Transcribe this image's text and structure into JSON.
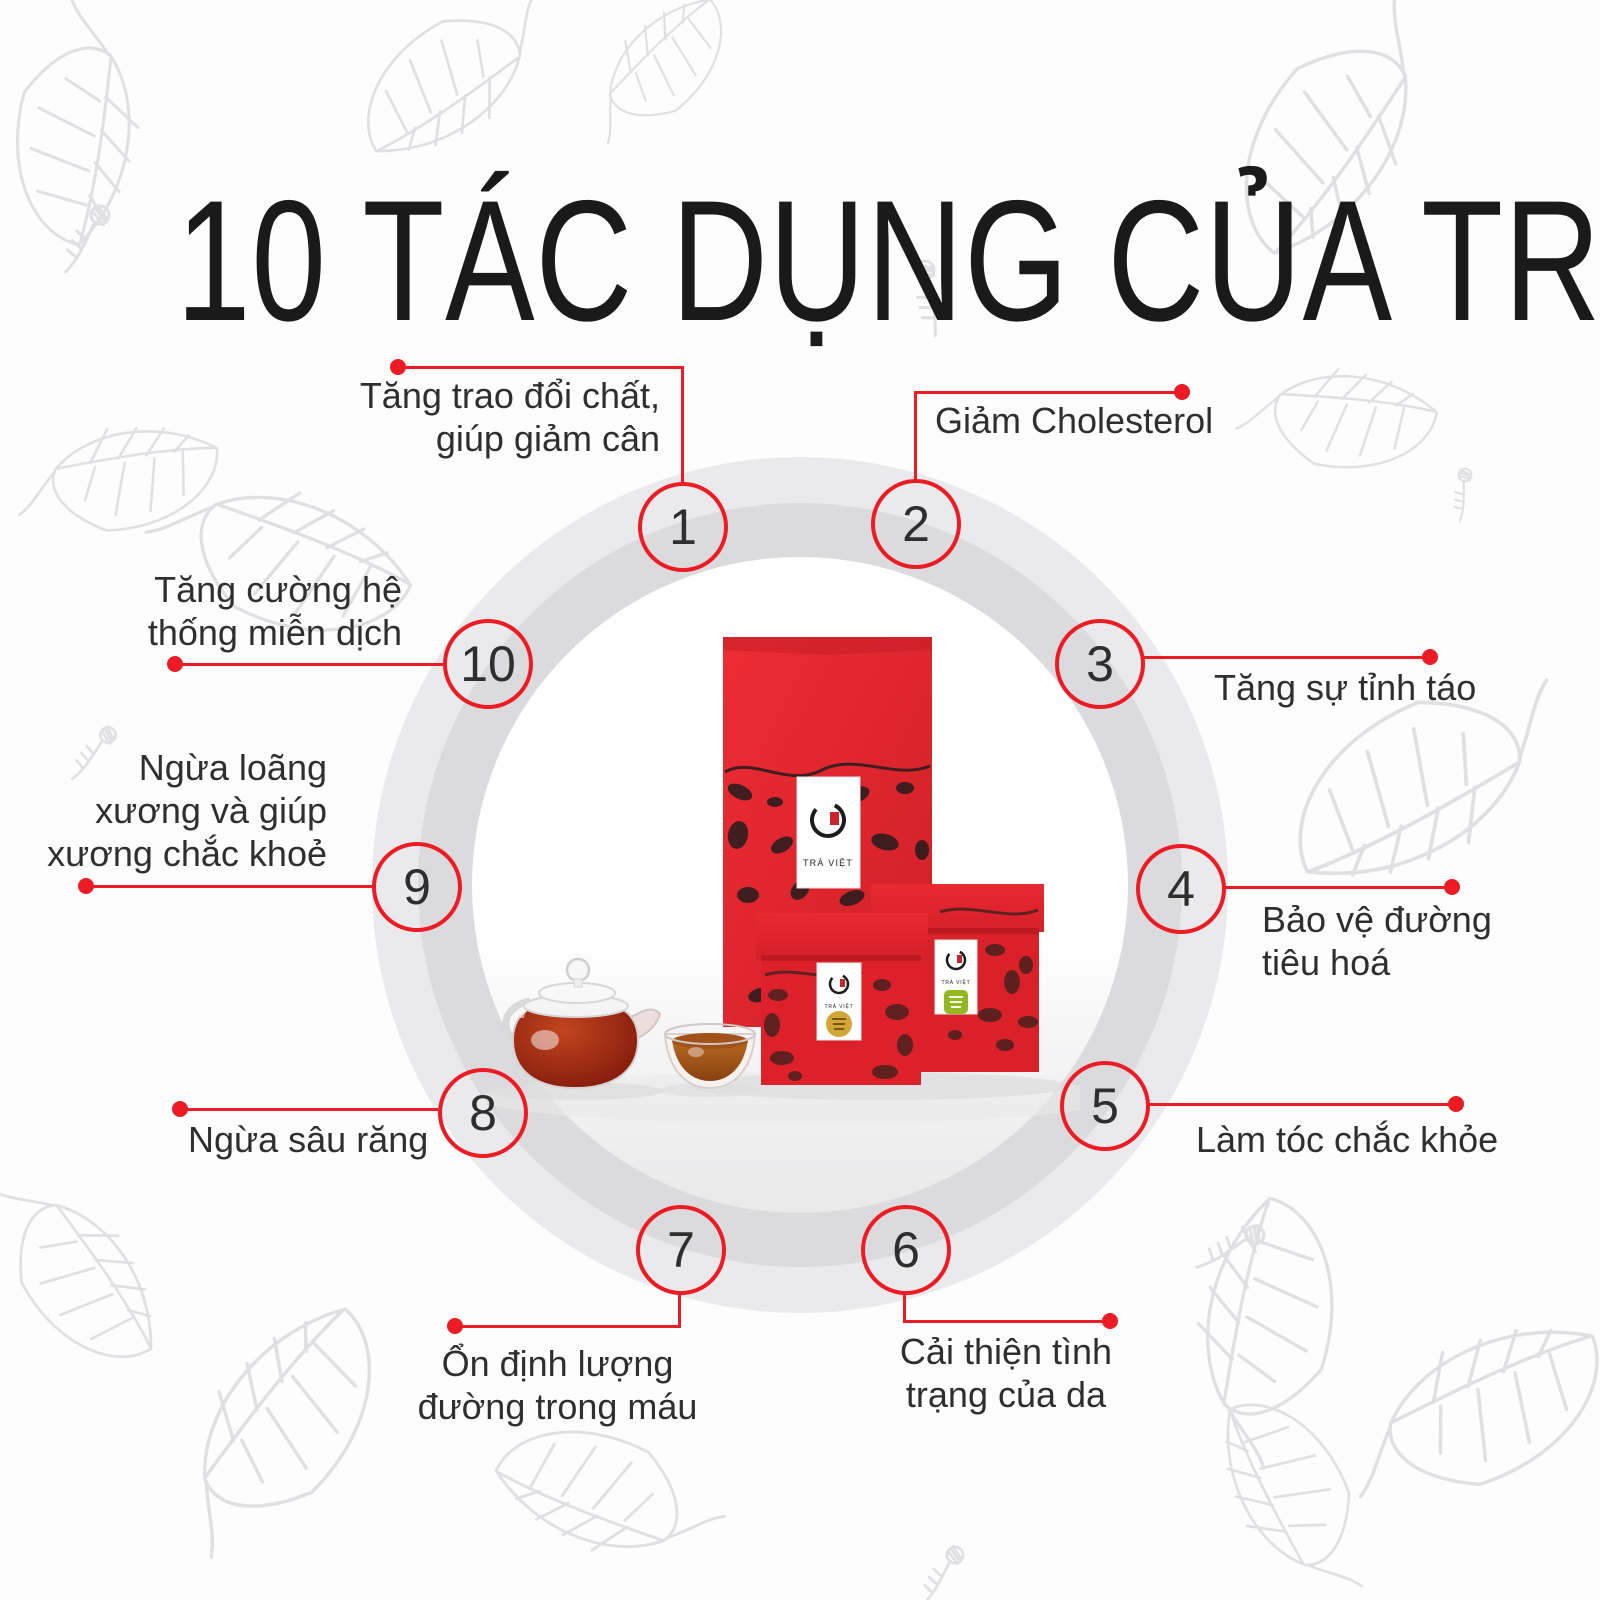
{
  "title": "10 TÁC DỤNG CỦA TRÀ",
  "brand": "TRÀ VIỆT",
  "colors": {
    "accent": "#ed1c24",
    "text": "#2f2f2f",
    "title": "#1a1a1a",
    "ringOuter": "#eaeaec",
    "ringMid": "#dbdbdd",
    "leafLine": "#e0e0e2",
    "boxRed": "#e2242d",
    "boxRedDark": "#c01c25",
    "gold": "#d2a636",
    "green": "#93b821",
    "teaDark": "#7c160a",
    "teaLight": "#c2451f",
    "cupTea": "#a55a1b"
  },
  "items": [
    {
      "number": "1",
      "label": "Tăng trao đổi chất,\ngiúp giảm cân"
    },
    {
      "number": "2",
      "label": "Giảm Cholesterol"
    },
    {
      "number": "3",
      "label": "Tăng sự tỉnh táo"
    },
    {
      "number": "4",
      "label": "Bảo vệ đường\ntiêu hoá"
    },
    {
      "number": "5",
      "label": "Làm tóc chắc khỏe"
    },
    {
      "number": "6",
      "label": "Cải thiện tình\ntrạng của da"
    },
    {
      "number": "7",
      "label": "Ổn định lượng\nđường trong máu"
    },
    {
      "number": "8",
      "label": "Ngừa sâu răng"
    },
    {
      "number": "9",
      "label": "Ngừa loãng\nxương và giúp\nxương chắc khoẻ"
    },
    {
      "number": "10",
      "label": "Tăng cường hệ\nthống miễn dịch"
    }
  ]
}
